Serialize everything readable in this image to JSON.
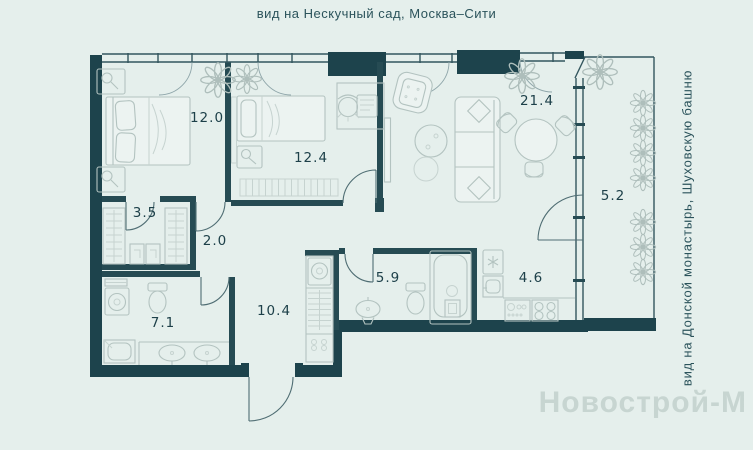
{
  "captions": {
    "top": "вид на Нескучный сад, Москва–Сити",
    "right": "вид на Донской монастырь, Шуховскую башню"
  },
  "watermark": {
    "text": "Новострой-М",
    "color": "#c7d5d1"
  },
  "colors": {
    "background": "#e5efec",
    "exterior_wall": "#1d434c",
    "interior_wall": "#264b53",
    "furniture_line": "#b3c3c0",
    "label_text": "#1d4049"
  },
  "rooms": [
    {
      "id": "bedroom-1",
      "area": "12.0"
    },
    {
      "id": "bedroom-2",
      "area": "12.4"
    },
    {
      "id": "living-room",
      "area": "21.4"
    },
    {
      "id": "balcony",
      "area": "5.2"
    },
    {
      "id": "wardrobe",
      "area": "3.5"
    },
    {
      "id": "hall",
      "area": "2.0"
    },
    {
      "id": "bathroom-1",
      "area": "7.1"
    },
    {
      "id": "corridor",
      "area": "10.4"
    },
    {
      "id": "bathroom-2",
      "area": "5.9"
    },
    {
      "id": "kitchen",
      "area": "4.6"
    }
  ]
}
